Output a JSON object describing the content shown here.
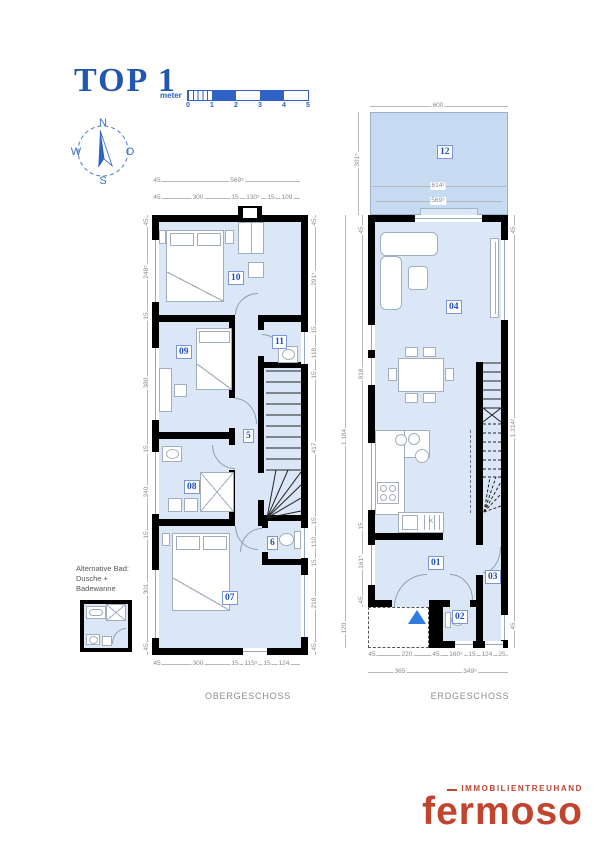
{
  "title": "TOP 1",
  "scale_bar": {
    "unit": "meter",
    "ticks": [
      "0",
      "1",
      "2",
      "3",
      "4",
      "5"
    ]
  },
  "compass": {
    "north": "N",
    "east": "O",
    "south": "S",
    "west": "W"
  },
  "upper_floor": {
    "label": "OBERGESCHOSS",
    "rooms": {
      "r10": "10",
      "r09": "09",
      "r11": "11",
      "r05": "5",
      "r08": "08",
      "r06": "6",
      "r07": "07"
    },
    "dims": {
      "top_total": [
        "45",
        "569⁵"
      ],
      "top": [
        "45",
        "300",
        "15",
        "130⁵",
        "15",
        "109"
      ],
      "bottom": [
        "45",
        "300",
        "15",
        "115⁵",
        "15",
        "124"
      ],
      "left": [
        "45",
        "248⁵",
        "15",
        "380",
        "15",
        "240",
        "15",
        "301",
        "45"
      ],
      "right": [
        "45",
        "291⁵",
        "15",
        "118",
        "15",
        "417",
        "15",
        "110",
        "15",
        "218",
        "45"
      ]
    }
  },
  "ground_floor": {
    "label": "ERDGESCHOSS",
    "rooms": {
      "r12": "12",
      "r04": "04",
      "r01": "01",
      "r02": "02",
      "r03": "03"
    },
    "kitchen_label": "K",
    "dims": {
      "garden_top": "600",
      "garden_inner": [
        "614²",
        "569⁵"
      ],
      "garden_left": "301⁵",
      "left_outer": [
        "1.184",
        "120"
      ],
      "left_inner": [
        "45",
        "918",
        "15",
        "161⁵",
        "45"
      ],
      "right": [
        "45",
        "1.214²",
        "45"
      ],
      "bottom_upper": [
        "45",
        "220",
        "45",
        "160⁵",
        "15",
        "124",
        "25"
      ],
      "bottom_lower": [
        "365",
        "349⁵"
      ]
    }
  },
  "note": {
    "line1": "Alternative Bad:",
    "line2": "Dusche +",
    "line3": "Badewanne"
  },
  "logo": {
    "top": "IMMOBILIENTREUHAND",
    "name": "fermoso"
  },
  "colors": {
    "accent_blue": "#2257b0",
    "room_fill": "#dbe7f6",
    "garden_fill": "#c6dbf2",
    "logo_red": "#c0442e",
    "dim_gray": "#8a8a8a",
    "label_blue": "#1d4fc0"
  }
}
